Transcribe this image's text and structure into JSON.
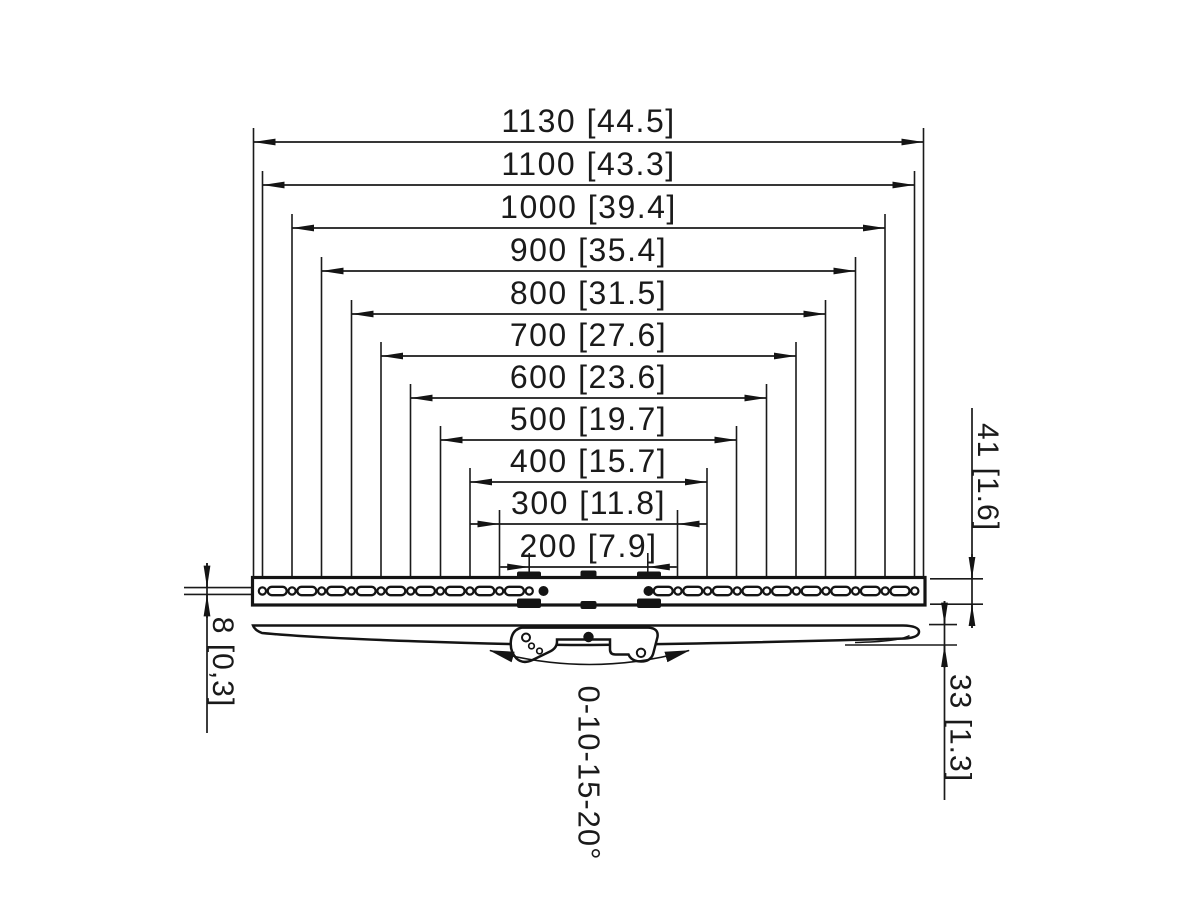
{
  "diagram": {
    "type": "technical-dimension-drawing",
    "subject": "Wall-mount rail with slotted mounting holes: front view (top) and curved profile view with tilt bracket (bottom)",
    "colors": {
      "line": "#1a1a1a",
      "background": "#ffffff"
    },
    "horizontal_dimensions": [
      {
        "label": "1130 [44.5]",
        "mm": 1130,
        "inch": "44.5"
      },
      {
        "label": "1100 [43.3]",
        "mm": 1100,
        "inch": "43.3"
      },
      {
        "label": "1000 [39.4]",
        "mm": 1000,
        "inch": "39.4"
      },
      {
        "label": "900 [35.4]",
        "mm": 900,
        "inch": "35.4"
      },
      {
        "label": "800 [31.5]",
        "mm": 800,
        "inch": "31.5"
      },
      {
        "label": "700 [27.6]",
        "mm": 700,
        "inch": "27.6"
      },
      {
        "label": "600 [23.6]",
        "mm": 600,
        "inch": "23.6"
      },
      {
        "label": "500 [19.7]",
        "mm": 500,
        "inch": "19.7"
      },
      {
        "label": "400 [15.7]",
        "mm": 400,
        "inch": "15.7"
      },
      {
        "label": "300 [11.8]",
        "mm": 300,
        "inch": "11.8"
      },
      {
        "label": "200 [7.9]",
        "mm": 200,
        "inch": "7.9"
      }
    ],
    "vertical_dimensions": {
      "rail_height": {
        "label": "41 [1.6]",
        "mm": 41,
        "inch": "1.6"
      },
      "profile_depth": {
        "label": "33 [1.3]",
        "mm": 33,
        "inch": "1.3"
      },
      "slot_height": {
        "label": "8 [0,3]",
        "mm": 8,
        "inch": "0,3"
      }
    },
    "tilt_range": {
      "label": "0-10-15-20°",
      "degrees": [
        0,
        10,
        15,
        20
      ]
    }
  }
}
